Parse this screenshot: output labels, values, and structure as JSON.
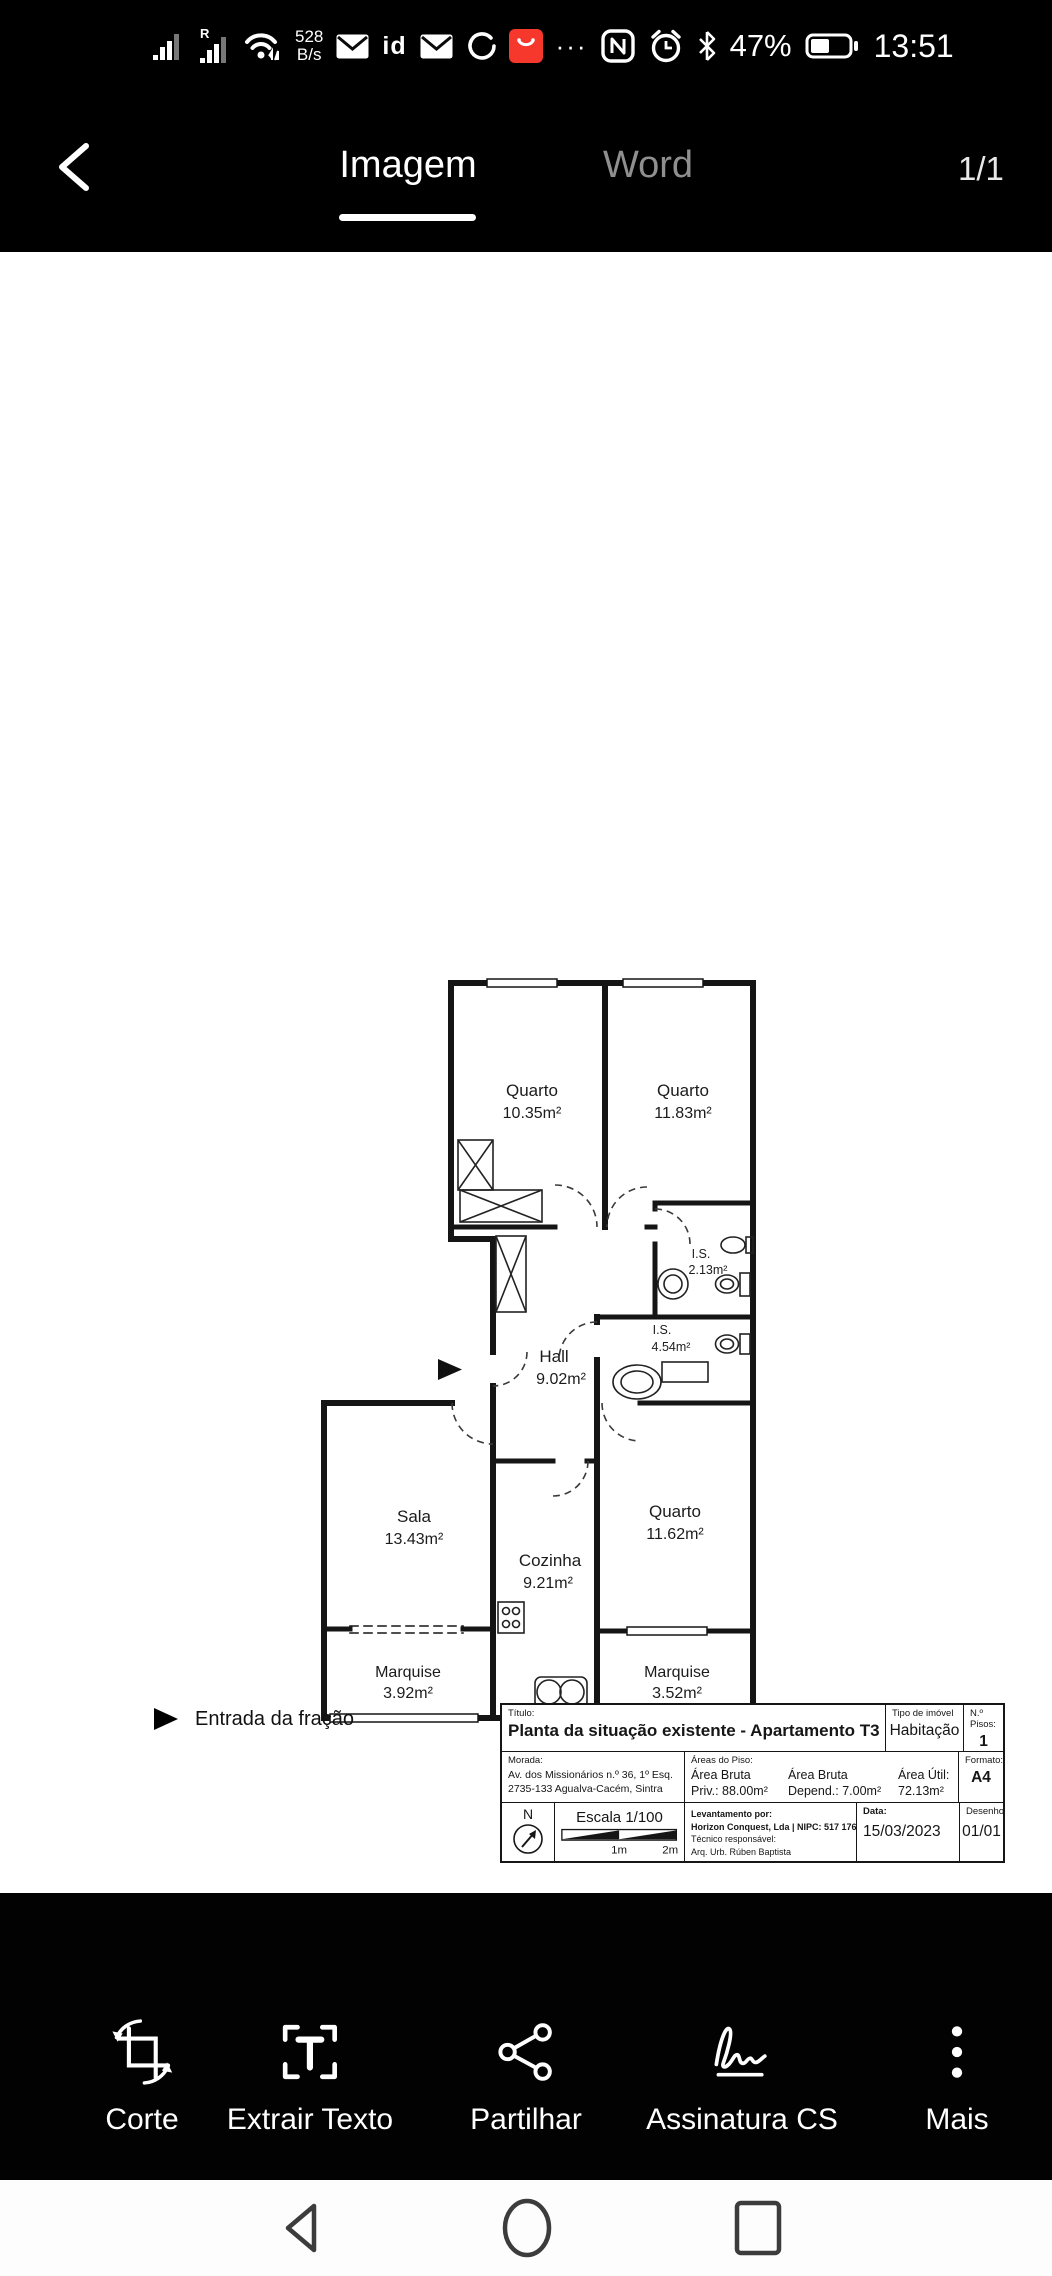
{
  "status_bar": {
    "roaming_indicator": "R",
    "network_speed_value": "528",
    "network_speed_unit": "B/s",
    "id_badge": "id",
    "overflow_dots": "···",
    "battery_percent": "47%",
    "time": "13:51"
  },
  "header": {
    "tabs": [
      {
        "label": "Imagem"
      },
      {
        "label": "Word"
      }
    ],
    "page_indicator": "1/1"
  },
  "floorplan": {
    "rooms": [
      {
        "name": "Quarto",
        "area": "10.35m²"
      },
      {
        "name": "Quarto",
        "area": "11.83m²"
      },
      {
        "name": "I.S.",
        "area": "2.13m²"
      },
      {
        "name": "I.S.",
        "area": "4.54m²"
      },
      {
        "name": "Hall",
        "area": "9.02m²"
      },
      {
        "name": "Sala",
        "area": "13.43m²"
      },
      {
        "name": "Cozinha",
        "area": "9.21m²"
      },
      {
        "name": "Quarto",
        "area": "11.62m²"
      },
      {
        "name": "Marquise",
        "area": "3.92m²"
      },
      {
        "name": "Marquise",
        "area": "3.52m²"
      }
    ],
    "entrance_label": "Entrada da fração"
  },
  "title_block": {
    "titulo_label": "Título:",
    "titulo": "Planta da situação existente - Apartamento T3",
    "tipo_label": "Tipo de imóvel",
    "tipo": "Habitação",
    "pisos_label": "N.º Pisos:",
    "pisos": "1",
    "morada_label": "Morada:",
    "morada_line1": "Av. dos Missionários n.º 36, 1º Esq.",
    "morada_line2": "2735-133 Agualva-Cacém, Sintra",
    "areas_label": "Áreas do Piso:",
    "area_bruta_priv_l1": "Área Bruta",
    "area_bruta_priv_l2": "Priv.: 88.00m²",
    "area_bruta_dep_l1": "Área Bruta",
    "area_bruta_dep_l2": "Depend.: 7.00m²",
    "area_util_l1": "Área Útil:",
    "area_util_l2": "72.13m²",
    "formato_label": "Formato:",
    "formato": "A4",
    "north_label": "N",
    "escala": "Escala 1/100",
    "scale_1m": "1m",
    "scale_2m": "2m",
    "levantamento_label": "Levantamento por:",
    "levantamento_value": "Horizon Conquest, Lda | NIPC: 517 176 297",
    "tecnico_label": "Técnico responsável:",
    "tecnico_value": "Arq. Urb. Rúben Baptista",
    "data_label": "Data:",
    "data_value": "15/03/2023",
    "desenho_label": "Desenho",
    "desenho_value": "01/01"
  },
  "toolbar": {
    "items": [
      {
        "label": "Corte"
      },
      {
        "label": "Extrair Texto"
      },
      {
        "label": "Partilhar"
      },
      {
        "label": "Assinatura CS"
      },
      {
        "label": "Mais"
      }
    ]
  },
  "colors": {
    "accent_red": "#f5372c",
    "header_bg": "#000000",
    "canvas_bg": "#ffffff"
  }
}
